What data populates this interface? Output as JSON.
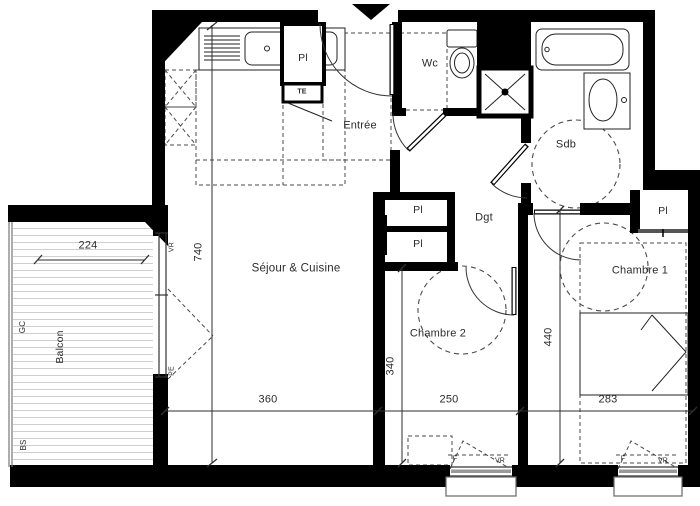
{
  "plan_title": "Plan d'appartement",
  "rooms": {
    "sejour": {
      "label": "Séjour & Cuisine"
    },
    "entree": {
      "label": "Entrée"
    },
    "wc": {
      "label": "Wc"
    },
    "sdb": {
      "label": "Sdb"
    },
    "dgt": {
      "label": "Dgt"
    },
    "chambre1": {
      "label": "Chambre 1"
    },
    "chambre2": {
      "label": "Chambre 2"
    },
    "balcon": {
      "label": "Balcon"
    }
  },
  "closets": {
    "kitchen_pl": "Pl",
    "te": "TE",
    "hall_pl_1": "Pl",
    "hall_pl_2": "Pl",
    "chambre1_pl": "Pl"
  },
  "dimensions_cm": {
    "balcony_width": "224",
    "sejour_depth": "740",
    "sejour_width": "360",
    "chambre2_width": "250",
    "chambre2_depth": "340",
    "chambre1_width": "283",
    "chambre1_depth": "440"
  },
  "annotations": {
    "gc": "GC",
    "bs": "BS",
    "balcony_vr": "VR",
    "balcony_pe": "PE",
    "chambre2_window_f": "F",
    "chambre2_window_vr": "VR",
    "chambre1_window_f": "F",
    "chambre1_window_vr": "VR"
  },
  "colors": {
    "wall": "#000000",
    "line": "#222222",
    "dashed": "#4a4a4a",
    "deck": "#cfcfcf",
    "background": "#ffffff"
  }
}
